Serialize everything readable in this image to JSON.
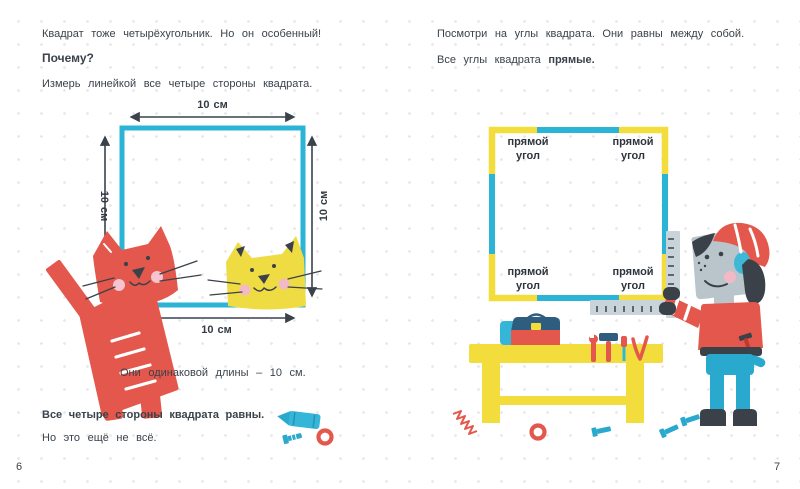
{
  "colors": {
    "blue": "#2bb4d6",
    "yellow": "#f3dd3c",
    "red": "#e4574c",
    "dark": "#3a4149",
    "dog_gray": "#b9c5cb",
    "pink": "#f3b9c6",
    "text": "#3a424b"
  },
  "left_page": {
    "intro": "Квадрат тоже четырёхугольник. Но он особенный!",
    "question_heading": "Почему?",
    "instruction": "Измерь линейкой все четыре стороны квадрата.",
    "dimension_labels": {
      "top": "10 см",
      "left": "10 см",
      "right": "10 см",
      "bottom": "10 см"
    },
    "result_line": "Они одинаковой длины – 10 см.",
    "conclusion_bold": "Все четыре стороны квадрата равны.",
    "conclusion_rest": "Но это ещё не всё.",
    "page_number": "6"
  },
  "right_page": {
    "intro": "Посмотри на углы квадрата. Они равны между собой.",
    "statement_prefix": "Все углы квадрата",
    "statement_bold": "прямые.",
    "corner_labels": {
      "top_left": "прямой угол",
      "top_right": "прямой угол",
      "bottom_left": "прямой угол",
      "bottom_right": "прямой угол"
    },
    "page_number": "7"
  }
}
